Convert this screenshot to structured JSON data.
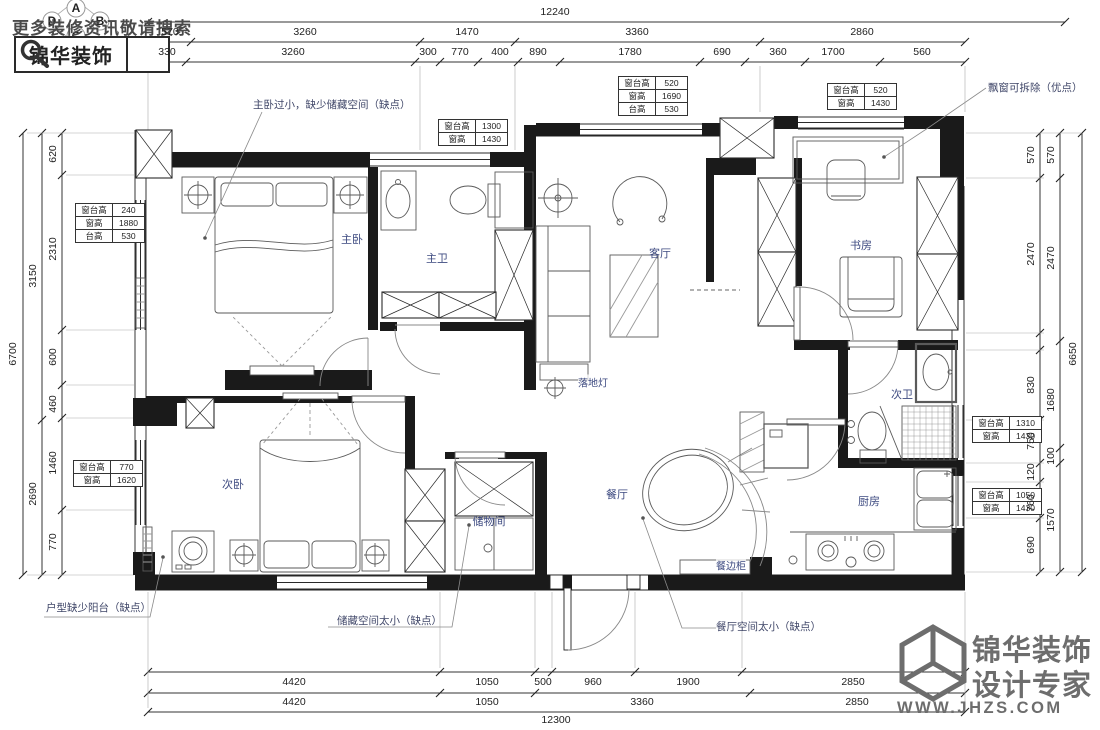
{
  "watermark": "更多装修资讯敬请搜索",
  "brand_box": {
    "name": "锦华装饰"
  },
  "compass": {
    "a": "A",
    "b": "B",
    "c": "C",
    "d": "D"
  },
  "rooms": {
    "master_bedroom": "主卧",
    "master_bath": "主卫",
    "living": "客厅",
    "study": "书房",
    "second_bedroom": "次卧",
    "storage": "储物间",
    "dining": "餐厅",
    "second_bath": "次卫",
    "kitchen": "厨房"
  },
  "labels": {
    "floor_lamp": "落地灯",
    "sideboard": "餐边柜"
  },
  "annotations": {
    "master": "主卧过小，缺少储藏空间（缺点）",
    "bay": "飘窗可拆除（优点）",
    "balcony": "户型缺少阳台（缺点）",
    "storage": "储藏空间太小（缺点）",
    "dining": "餐厅空间太小（缺点）"
  },
  "window_tables": [
    {
      "rows": [
        [
          "窗台高",
          "240"
        ],
        [
          "窗高",
          "1880"
        ],
        [
          "台高",
          "530"
        ]
      ]
    },
    {
      "rows": [
        [
          "窗台高",
          "770"
        ],
        [
          "窗高",
          "1620"
        ]
      ]
    },
    {
      "rows": [
        [
          "窗台高",
          "520"
        ],
        [
          "窗高",
          "1690"
        ],
        [
          "台高",
          "530"
        ]
      ]
    },
    {
      "rows": [
        [
          "窗台高",
          "1300"
        ],
        [
          "窗高",
          "1430"
        ]
      ]
    },
    {
      "rows": [
        [
          "窗台高",
          "520"
        ],
        [
          "窗高",
          "1430"
        ]
      ]
    },
    {
      "rows": [
        [
          "窗台高",
          "1310"
        ],
        [
          "窗高",
          "1430"
        ]
      ]
    },
    {
      "rows": [
        [
          "窗台高",
          "1050"
        ],
        [
          "窗高",
          "1430"
        ]
      ]
    }
  ],
  "dimensions": {
    "top": {
      "overall": "12240",
      "row2": [
        "570",
        "3260",
        "1470",
        "3360",
        "2860"
      ],
      "row3": [
        "330",
        "3260",
        "300",
        "770",
        "400",
        "890",
        "1780",
        "690",
        "360",
        "1700",
        "560"
      ]
    },
    "bottom": {
      "row1": [
        "4420",
        "1050",
        "500",
        "960",
        "1900",
        "2850"
      ],
      "row2": [
        "4420",
        "1050",
        "3360",
        "2850"
      ],
      "overall": "12300"
    },
    "left": {
      "outer": "6700",
      "mid": [
        "3150",
        "2690"
      ],
      "inner": [
        "620",
        "2310",
        "600",
        "460",
        "1460",
        "770"
      ]
    },
    "right": {
      "outer": "6650",
      "mid": [
        "570",
        "2470",
        "1680",
        "100",
        "1570"
      ],
      "inner": [
        "570",
        "2470",
        "830",
        "750",
        "120",
        "760",
        "690"
      ]
    }
  },
  "footer": {
    "brand": "锦华装饰",
    "tagline": "设计专家",
    "website": "WWW.JHZS.COM"
  }
}
